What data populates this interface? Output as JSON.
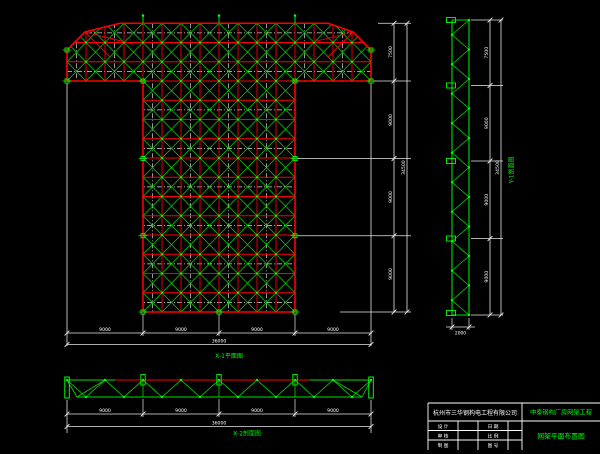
{
  "colors": {
    "bg": "#000000",
    "red": "#ff0000",
    "green": "#00e000",
    "bright_green": "#00ff00",
    "white": "#ffffff",
    "dim_line": "#e8e8e8",
    "axis": "#d8d8d8",
    "gray": "#8c8c8c"
  },
  "plan": {
    "title": "X-1平面图",
    "dims_bottom": [
      "9000",
      "9000",
      "9000",
      "9000"
    ],
    "dim_bottom_total": "36000",
    "dims_right": [
      "7500",
      "9000",
      "9000",
      "9000"
    ],
    "dim_right_total": "34500"
  },
  "side_truss": {
    "title": "Y-1剖面图",
    "dims": [
      "7500",
      "9000",
      "9000",
      "9000"
    ],
    "dim_total": "34500",
    "dim_width": "2000"
  },
  "bottom_truss": {
    "title": "X-2剖面图",
    "dims": [
      "9000",
      "9000",
      "9000",
      "9000"
    ],
    "dim_total": "36000"
  },
  "title_block": {
    "company": "杭州市三华钢构电工程有限公司",
    "project": "中泰钢构厂房网架工程",
    "drawing_title": "网架平面布置图",
    "rows": [
      {
        "c1": "设 计",
        "c2": "",
        "c3": "日 期",
        "c4": ""
      },
      {
        "c1": "审 核",
        "c2": "",
        "c3": "比 例",
        "c4": ""
      },
      {
        "c1": "制 图",
        "c2": "",
        "c3": "图 号",
        "c4": ""
      }
    ]
  }
}
